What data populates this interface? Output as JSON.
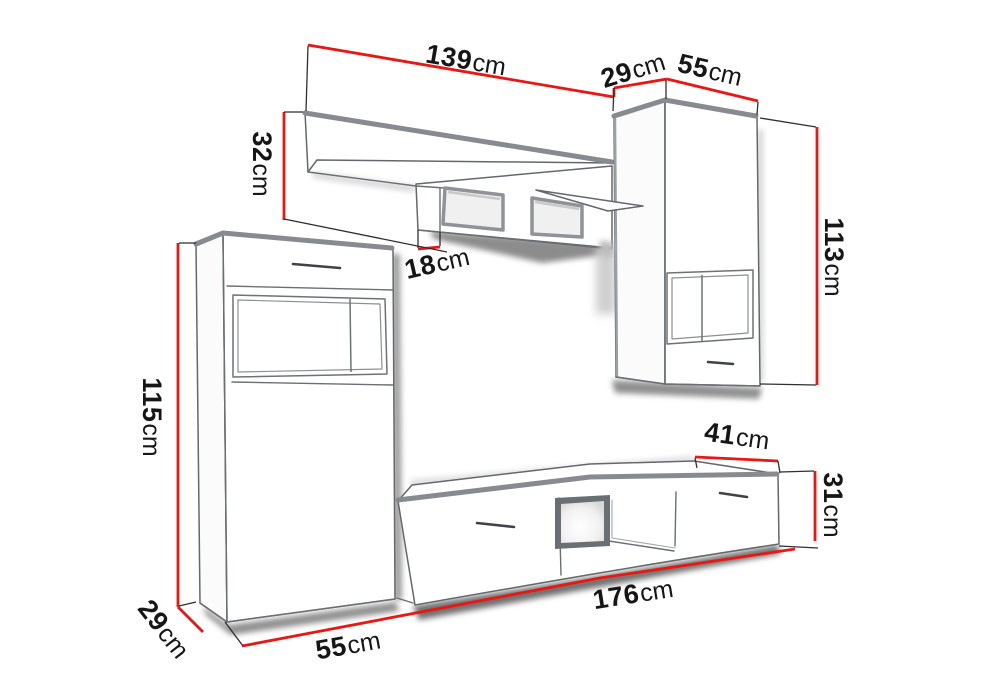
{
  "diagram": {
    "kind": "furniture wall-unit dimension drawing",
    "units": "cm",
    "colors": {
      "background": "#ffffff",
      "dimension_line": "#ea1611",
      "extension_line": "#2f2f2f",
      "outline": "#63686d",
      "label_text": "#161616"
    },
    "pieces": {
      "wall_shelf": {
        "width_cm": 139,
        "height_cm": 32,
        "depth_cm": 18
      },
      "upper_cabinet": {
        "depth_cm": 29,
        "width_cm": 55,
        "height_cm": 113
      },
      "tall_cabinet": {
        "height_cm": 115,
        "depth_cm": 29,
        "width_cm": 55
      },
      "tv_stand": {
        "width_cm": 176,
        "depth_cm": 41,
        "height_cm": 31
      }
    }
  },
  "dimensions": {
    "shelf_width": {
      "value": "139",
      "unit": "cm"
    },
    "upper_cabinet_depth": {
      "value": "29",
      "unit": "cm"
    },
    "upper_cabinet_width": {
      "value": "55",
      "unit": "cm"
    },
    "shelf_height": {
      "value": "32",
      "unit": "cm"
    },
    "shelf_depth": {
      "value": "18",
      "unit": "cm"
    },
    "upper_cabinet_height": {
      "value": "113",
      "unit": "cm"
    },
    "tall_cabinet_height": {
      "value": "115",
      "unit": "cm"
    },
    "tall_cabinet_depth": {
      "value": "29",
      "unit": "cm"
    },
    "tall_cabinet_width": {
      "value": "55",
      "unit": "cm"
    },
    "tv_stand_width": {
      "value": "176",
      "unit": "cm"
    },
    "tv_stand_depth": {
      "value": "41",
      "unit": "cm"
    },
    "tv_stand_height": {
      "value": "31",
      "unit": "cm"
    }
  }
}
